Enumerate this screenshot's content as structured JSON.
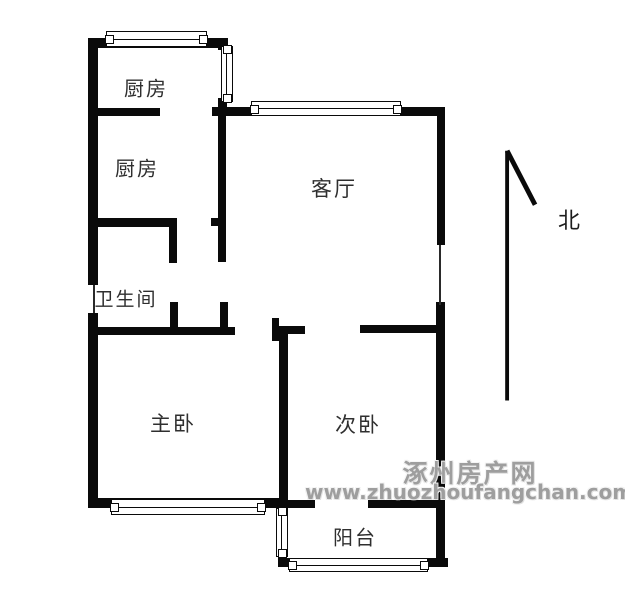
{
  "meta": {
    "background_color": "#ffffff",
    "wall_color": "#0a0a0a",
    "label_color": "#2f2f2f",
    "watermark_color": "#9e9e9e"
  },
  "rooms": [
    {
      "name": "kitchen-upper",
      "label": "厨房",
      "cx": 146,
      "cy": 87,
      "fs": 20
    },
    {
      "name": "kitchen-lower",
      "label": "厨房",
      "cx": 137,
      "cy": 167,
      "fs": 20
    },
    {
      "name": "living-room",
      "label": "客厅",
      "cx": 334,
      "cy": 188,
      "fs": 21
    },
    {
      "name": "bathroom",
      "label": "卫生间",
      "cx": 126,
      "cy": 298,
      "fs": 19
    },
    {
      "name": "master-bedroom",
      "label": "主卧",
      "cx": 173,
      "cy": 423,
      "fs": 21
    },
    {
      "name": "second-bedroom",
      "label": "次卧",
      "cx": 358,
      "cy": 424,
      "fs": 21
    },
    {
      "name": "balcony",
      "label": "阳台",
      "cx": 355,
      "cy": 536,
      "fs": 20
    }
  ],
  "compass": {
    "label": "北",
    "cx": 569,
    "cy": 219
  },
  "watermark": {
    "site_name": "涿州房产网",
    "site_url": "www.zhuozhoufangchan.com"
  },
  "plan": {
    "walls": [
      [
        88,
        38,
        140,
        10
      ],
      [
        88,
        38,
        10,
        247
      ],
      [
        88,
        313,
        10,
        195
      ],
      [
        92,
        108,
        68,
        8
      ],
      [
        212,
        107,
        233,
        9
      ],
      [
        218,
        38,
        10,
        12
      ],
      [
        218,
        98,
        9,
        18
      ],
      [
        218,
        114,
        8,
        148
      ],
      [
        211,
        218,
        7,
        8
      ],
      [
        92,
        218,
        85,
        9
      ],
      [
        169,
        227,
        8,
        36
      ],
      [
        170,
        302,
        8,
        26
      ],
      [
        220,
        302,
        8,
        26
      ],
      [
        88,
        327,
        147,
        8
      ],
      [
        272,
        326,
        33,
        8
      ],
      [
        272,
        318,
        7,
        23
      ],
      [
        279,
        334,
        9,
        166
      ],
      [
        360,
        325,
        85,
        8
      ],
      [
        437,
        108,
        8,
        137
      ],
      [
        436,
        302,
        9,
        265
      ],
      [
        88,
        498,
        200,
        10
      ],
      [
        288,
        500,
        27,
        8
      ],
      [
        368,
        500,
        77,
        8
      ],
      [
        278,
        558,
        170,
        9
      ]
    ],
    "thin_lines": [
      [
        93,
        285,
        2,
        28
      ],
      [
        439,
        245,
        2,
        60
      ]
    ],
    "windows": [
      {
        "x": 106,
        "y": 31,
        "w": 101,
        "h": 16,
        "dir": "h"
      },
      {
        "x": 251,
        "y": 101,
        "w": 150,
        "h": 15,
        "dir": "h"
      },
      {
        "x": 221,
        "y": 46,
        "w": 12,
        "h": 56,
        "dir": "v"
      },
      {
        "x": 111,
        "y": 499,
        "w": 154,
        "h": 16,
        "dir": "h"
      },
      {
        "x": 276,
        "y": 508,
        "w": 12,
        "h": 49,
        "dir": "v"
      },
      {
        "x": 289,
        "y": 558,
        "w": 139,
        "h": 14,
        "dir": "h"
      }
    ]
  }
}
